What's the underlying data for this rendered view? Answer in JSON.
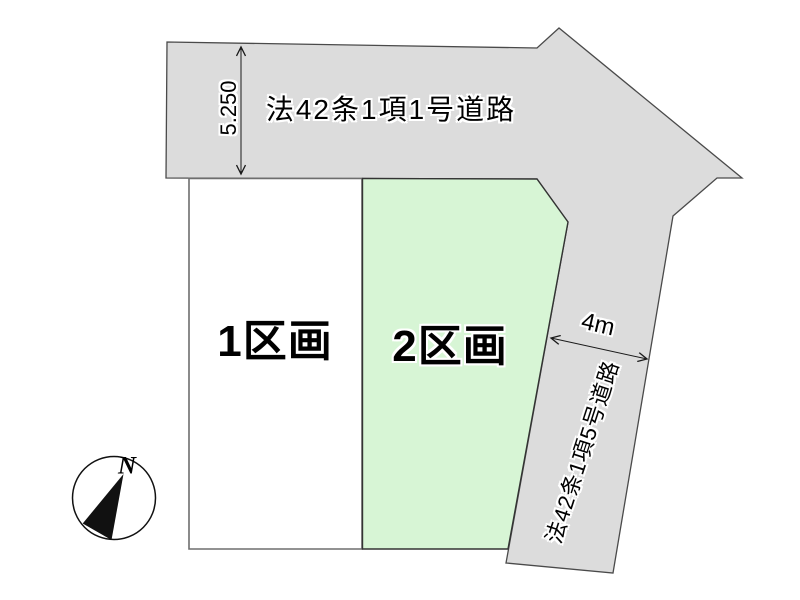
{
  "diagram": {
    "top_road": {
      "label": "法42条1項1号道路",
      "width_dimension": "5.250"
    },
    "side_road": {
      "label": "法42条1項5号道路",
      "width_dimension": "4m"
    },
    "plots": [
      {
        "label": "1区画"
      },
      {
        "label": "2区画"
      }
    ],
    "compass": {
      "north_label": "N"
    },
    "colors": {
      "road_fill": "#dcdcdc",
      "road_outline": "#4a4a4a",
      "plot1_fill": "#ffffff",
      "plot1_outline": "#6e6e6e",
      "plot2_fill": "#d7f5d5",
      "plot2_outline": "#333333",
      "dimension_line": "#1a1a1a",
      "text": "#000000"
    }
  }
}
